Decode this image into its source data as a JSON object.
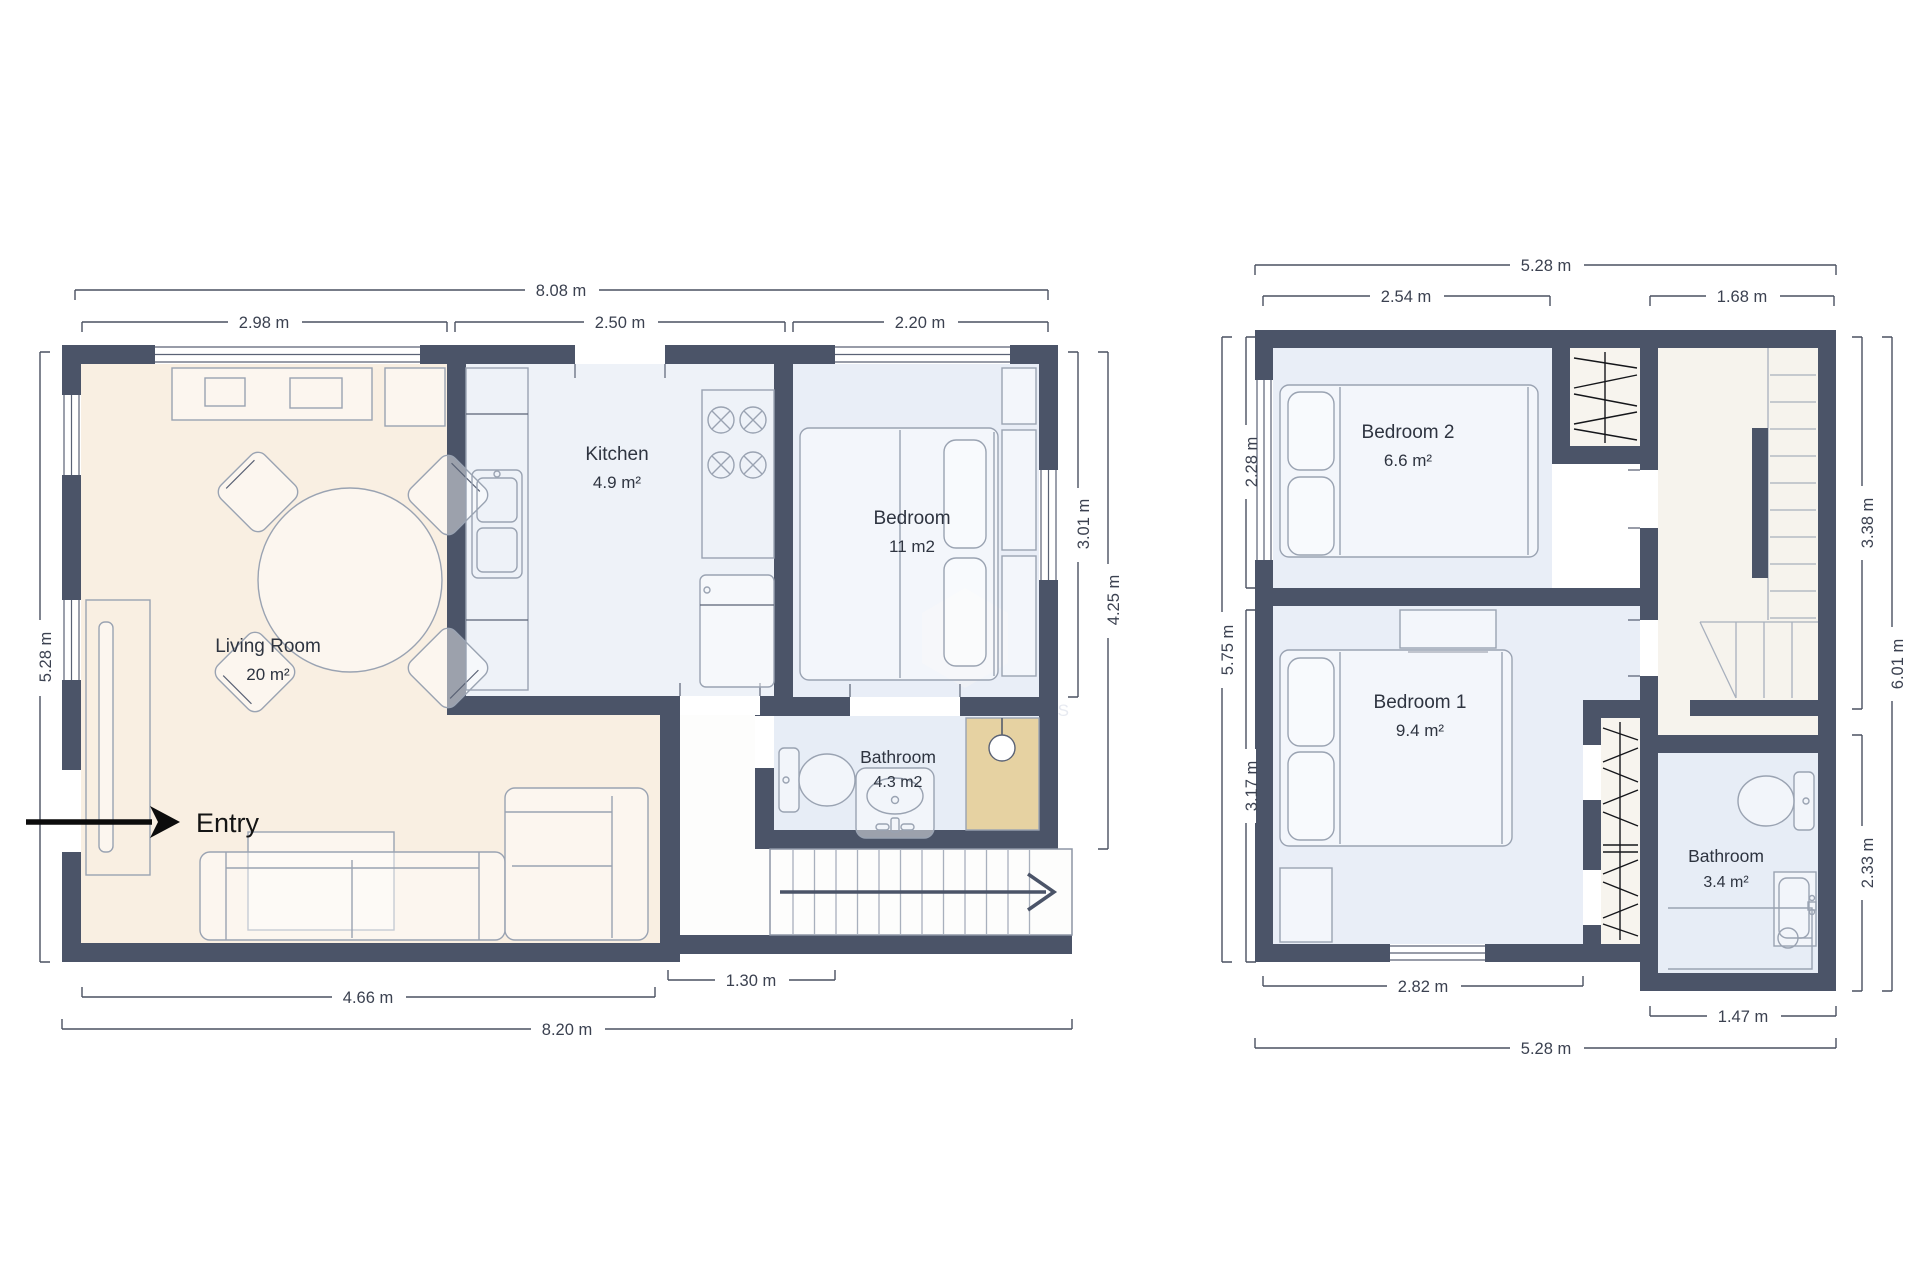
{
  "ground": {
    "title_living": "Living Room",
    "area_living": "20 m²",
    "title_kitchen": "Kitchen",
    "area_kitchen": "4.9 m²",
    "title_bedroom": "Bedroom",
    "area_bedroom": "11 m2",
    "title_bathroom": "Bathroom",
    "area_bathroom": "4.3 m2",
    "entry": "Entry",
    "dim_top_total": "8.08 m",
    "dim_top_living": "2.98 m",
    "dim_top_kitchen": "2.50 m",
    "dim_top_bedroom": "2.20 m",
    "dim_left": "5.28 m",
    "dim_right_bedroom": "3.01 m",
    "dim_right_total": "4.25 m",
    "dim_bottom_hall": "1.30 m",
    "dim_bottom_living": "4.66 m",
    "dim_bottom_total": "8.20 m"
  },
  "upper": {
    "title_bedroom2": "Bedroom 2",
    "area_bedroom2": "6.6 m²",
    "title_bedroom1": "Bedroom 1",
    "area_bedroom1": "9.4 m²",
    "title_bathroom": "Bathroom",
    "area_bathroom": "3.4 m²",
    "dim_top_total": "5.28 m",
    "dim_top_bedroom2": "2.54 m",
    "dim_top_landing": "1.68 m",
    "dim_left_total": "5.75 m",
    "dim_left_bedroom2": "2.28 m",
    "dim_left_bedroom1": "3.17 m",
    "dim_right_landing": "3.38 m",
    "dim_right_total": "6.01 m",
    "dim_right_bathroom": "2.33 m",
    "dim_bottom_bedroom1": "2.82 m",
    "dim_bottom_bathroom": "1.47 m",
    "dim_bottom_total": "5.28 m"
  },
  "watermark": "JJ PROPERTIES",
  "colors": {
    "wall": "#4b5468",
    "living_floor": "#f9efe2",
    "kitchen_floor": "#eef2f8",
    "bedroom_floor": "#e9eef7",
    "bathroom_floor": "#e7edf6",
    "hall_floor": "#fdfdfc",
    "landing_floor": "#f6f3ed",
    "closet_floor": "#f7f4ee",
    "shower_tan": "#e6d2a2",
    "dim_color": "#3b4150",
    "entry_color": "#141414"
  }
}
